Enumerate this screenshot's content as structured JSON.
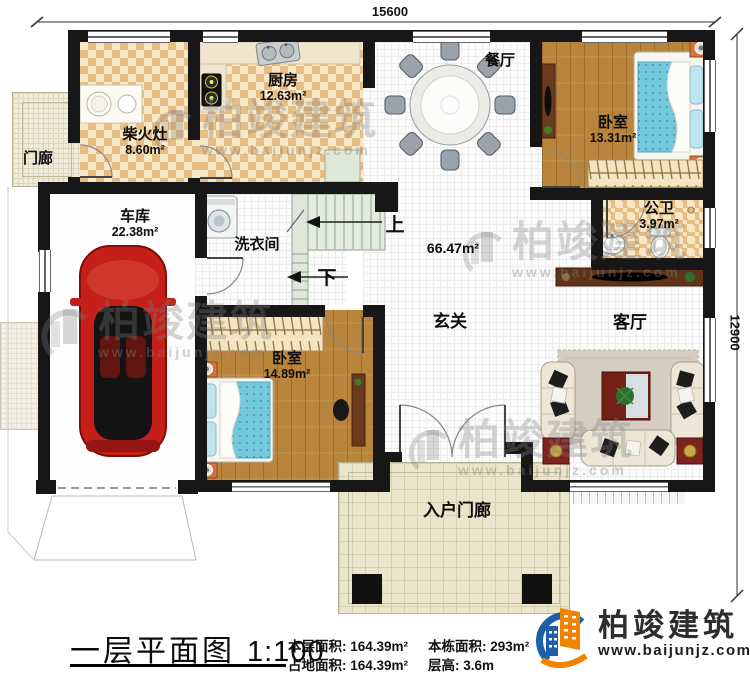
{
  "dimensions": {
    "top": "15600",
    "right": "12900"
  },
  "rooms": {
    "chaihuozao": {
      "name": "柴火灶",
      "area": "8.60m²"
    },
    "kitchen": {
      "name": "厨房",
      "area": "12.63m²"
    },
    "dining": {
      "name": "餐厅"
    },
    "bedroom_top": {
      "name": "卧室",
      "area": "13.31m²"
    },
    "bathroom": {
      "name": "公卫",
      "area": "3.97m²"
    },
    "porch": {
      "name": "门廊"
    },
    "garage": {
      "name": "车库",
      "area": "22.38m²"
    },
    "laundry": {
      "name": "洗衣间"
    },
    "bedroom_bottom": {
      "name": "卧室",
      "area": "14.89m²"
    },
    "foyer": {
      "name": "玄关"
    },
    "living": {
      "name": "客厅"
    },
    "entry_porch": {
      "name": "入户门廊"
    },
    "open_area": "66.47m²"
  },
  "stairs": {
    "up": "上",
    "down": "下"
  },
  "watermark": {
    "name": "柏竣建筑",
    "url": "www.baijunjz.com"
  },
  "footer": {
    "plan_title": "一层平面图",
    "scale": "1:100",
    "stats": [
      {
        "label": "本层面积:",
        "value": "164.39m²"
      },
      {
        "label": "占地面积:",
        "value": "164.39m²"
      },
      {
        "label": "本栋面积:",
        "value": "293m²"
      },
      {
        "label": "层高:",
        "value": "3.6m"
      }
    ],
    "brand": {
      "name": "柏竣建筑",
      "url": "www.baijunjz.com"
    }
  },
  "colors": {
    "wall": "#171717",
    "checker_tile": "#e7bd83",
    "wood_floor": "#b9843b",
    "mattress_blue": "#72c9de",
    "car_red": "#c42019",
    "brand_blue": "#1d5fa8",
    "brand_orange": "#f08300"
  }
}
